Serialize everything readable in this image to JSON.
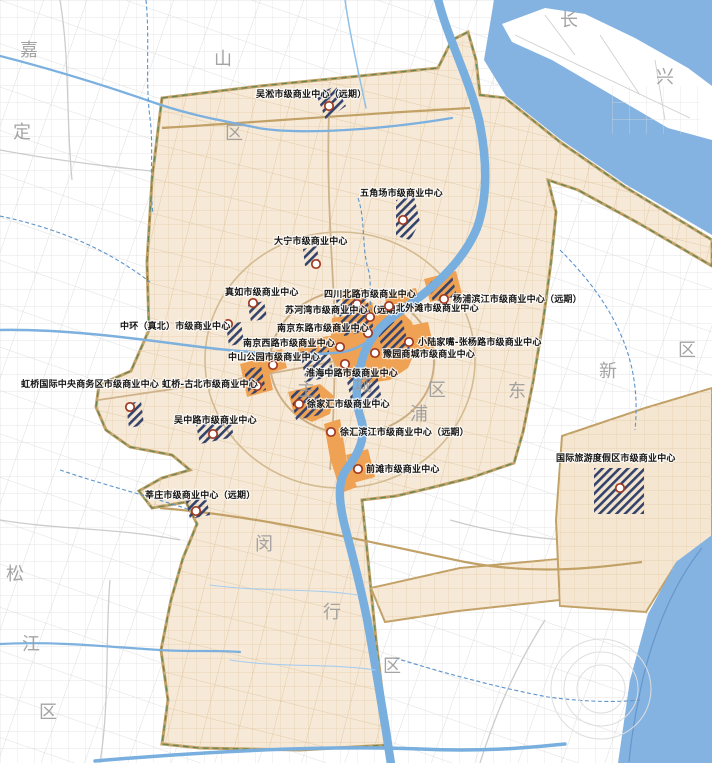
{
  "map": {
    "kind": "urban-planning-map",
    "subject": "市级商业中心布局",
    "colors": {
      "water": "#84b3e2",
      "urban_area_fill": "#f7e9d7",
      "urban_area_border": "#c2a167",
      "urban_boundary_dash": "#56824f",
      "core_commercial_zone": "#efa253",
      "planned_hatch": "#33436b",
      "marker_ring": "#a03a22",
      "outer_roads": "#dcdcdc",
      "inner_roads": "#e2cba8",
      "district_boundary": "#5b94cc",
      "watermark_text": "#9b9b9b",
      "label_text": "#141414"
    },
    "districts": [
      {
        "char": "嘉",
        "x": 20,
        "y": 56
      },
      {
        "char": "定",
        "x": 13,
        "y": 138
      },
      {
        "char": "山",
        "x": 214,
        "y": 65
      },
      {
        "char": "区",
        "x": 225,
        "y": 139
      },
      {
        "char": "长",
        "x": 560,
        "y": 26
      },
      {
        "char": "兴",
        "x": 656,
        "y": 83
      },
      {
        "char": "松",
        "x": 6,
        "y": 580
      },
      {
        "char": "江",
        "x": 22,
        "y": 650
      },
      {
        "char": "区",
        "x": 39,
        "y": 718
      },
      {
        "char": "闵",
        "x": 255,
        "y": 550
      },
      {
        "char": "行",
        "x": 323,
        "y": 618
      },
      {
        "char": "区",
        "x": 383,
        "y": 672
      },
      {
        "char": "主",
        "x": 297,
        "y": 396
      },
      {
        "char": "城",
        "x": 354,
        "y": 391
      },
      {
        "char": "区",
        "x": 428,
        "y": 396
      },
      {
        "char": "浦",
        "x": 410,
        "y": 420
      },
      {
        "char": "东",
        "x": 508,
        "y": 397
      },
      {
        "char": "新",
        "x": 599,
        "y": 377
      },
      {
        "char": "区",
        "x": 678,
        "y": 356
      }
    ],
    "commercial_centers": [
      {
        "name": "吴淞市级商业中心（远期）",
        "label_x": 256,
        "label_y": 97,
        "marker_x": 329,
        "marker_y": 106
      },
      {
        "name": "五角场市级商业中心",
        "label_x": 360,
        "label_y": 196,
        "marker_x": 403,
        "marker_y": 220
      },
      {
        "name": "大宁市级商业中心",
        "label_x": 274,
        "label_y": 244,
        "marker_x": 316,
        "marker_y": 264
      },
      {
        "name": "真如市级商业中心",
        "label_x": 225,
        "label_y": 295,
        "marker_x": 253,
        "marker_y": 303
      },
      {
        "name": "中环（真北）市级商业中心",
        "label_x": 120,
        "label_y": 329,
        "marker_x": 228,
        "marker_y": 324
      },
      {
        "name": "四川北路市级商业中心",
        "label_x": 324,
        "label_y": 297,
        "marker_x": 357,
        "marker_y": 304
      },
      {
        "name": "苏河湾市级商业中心（远期）",
        "label_x": 285,
        "label_y": 313,
        "marker_x": 370,
        "marker_y": 317
      },
      {
        "name": "南京东路市级商业中心",
        "label_x": 277,
        "label_y": 331,
        "marker_x": 368,
        "marker_y": 333
      },
      {
        "name": "南京西路市级商业中心",
        "label_x": 243,
        "label_y": 346,
        "marker_x": 340,
        "marker_y": 347
      },
      {
        "name": "中山公园市级商业中心",
        "label_x": 228,
        "label_y": 360,
        "marker_x": 273,
        "marker_y": 365
      },
      {
        "name": "淮海中路市级商业中心",
        "label_x": 306,
        "label_y": 376,
        "marker_x": 345,
        "marker_y": 364
      },
      {
        "name": "徐家汇市级商业中心",
        "label_x": 307,
        "label_y": 407,
        "marker_x": 299,
        "marker_y": 404
      },
      {
        "name": "徐汇滨江市级商业中心（远期）",
        "label_x": 340,
        "label_y": 435,
        "marker_x": 331,
        "marker_y": 432
      },
      {
        "name": "前滩市级商业中心",
        "label_x": 366,
        "label_y": 472,
        "marker_x": 358,
        "marker_y": 469
      },
      {
        "name": "小陆家嘴-张杨路市级商业中心",
        "label_x": 418,
        "label_y": 345,
        "marker_x": 409,
        "marker_y": 342
      },
      {
        "name": "豫园商城市级商业中心",
        "label_x": 383,
        "label_y": 357,
        "marker_x": 375,
        "marker_y": 353
      },
      {
        "name": "北外滩市级商业中心",
        "label_x": 396,
        "label_y": 311,
        "marker_x": 389,
        "marker_y": 306
      },
      {
        "name": "杨浦滨江市级商业中心（远期）",
        "label_x": 453,
        "label_y": 302,
        "marker_x": 444,
        "marker_y": 299
      },
      {
        "name": "国际旅游度假区市级商业中心",
        "label_x": 556,
        "label_y": 461,
        "marker_x": 620,
        "marker_y": 488
      },
      {
        "name": "虹桥国际中央商务区市级商业中心",
        "label_x": 21,
        "label_y": 387,
        "marker_x": 130,
        "marker_y": 407
      },
      {
        "name": "虹桥-古北市级商业中心",
        "label_x": 162,
        "label_y": 387,
        "marker_x": 257,
        "marker_y": 386
      },
      {
        "name": "吴中路市级商业中心",
        "label_x": 174,
        "label_y": 423,
        "marker_x": 213,
        "marker_y": 434
      },
      {
        "name": "莘庄市级商业中心（远期）",
        "label_x": 145,
        "label_y": 498,
        "marker_x": 196,
        "marker_y": 511
      }
    ]
  }
}
